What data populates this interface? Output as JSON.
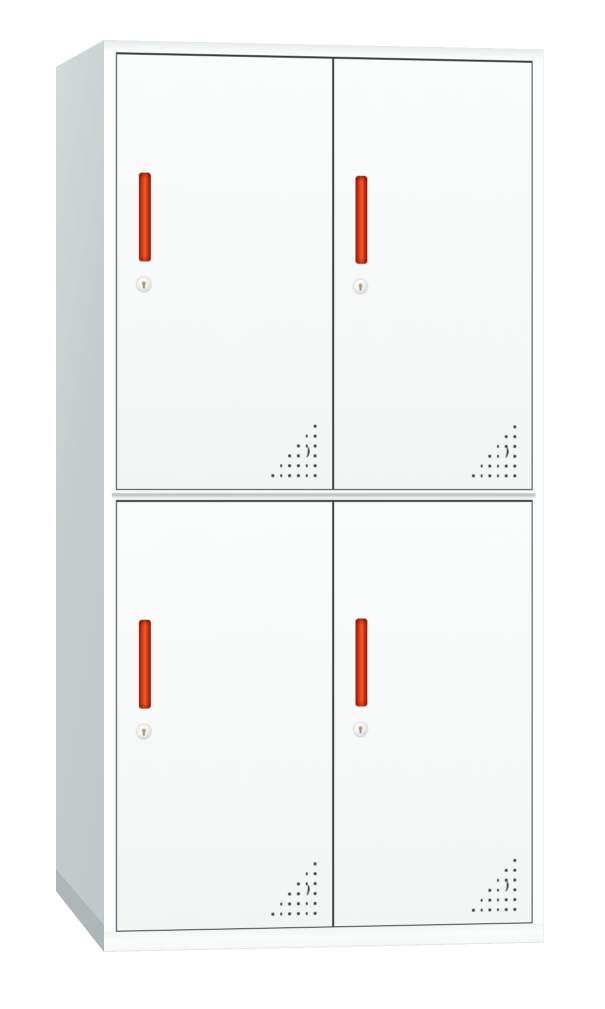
{
  "scene": {
    "type": "product-photo",
    "subject": "four-door metal locker cabinet",
    "background_color": "#ffffff"
  },
  "cabinet": {
    "rows": 2,
    "columns": 2,
    "door_count": 4,
    "body_color": "#fcfdfd",
    "side_panel_color": "#c7cdce",
    "door_color": "#f7f9f9",
    "door_border_color": "#3a3e41",
    "handle_color": "#e8491e",
    "handle_dark_color": "#8e1f0a",
    "lock_color": "#e9eae7",
    "vent_hole_color": "#3c3c3c",
    "doors": [
      {
        "id": "top-left",
        "handle": "red-vertical-bar",
        "lock": "round-cam-lock",
        "vents": "triangular-dot-grid"
      },
      {
        "id": "top-right",
        "handle": "red-vertical-bar",
        "lock": "round-cam-lock",
        "vents": "triangular-dot-grid"
      },
      {
        "id": "bottom-left",
        "handle": "red-vertical-bar",
        "lock": "round-cam-lock",
        "vents": "triangular-dot-grid"
      },
      {
        "id": "bottom-right",
        "handle": "red-vertical-bar",
        "lock": "round-cam-lock",
        "vents": "triangular-dot-grid"
      }
    ],
    "vent_pattern": {
      "rows": [
        [
          6
        ],
        [
          5,
          6
        ],
        [
          4,
          5,
          6
        ],
        [
          3,
          4,
          6
        ],
        [
          2,
          3,
          4,
          5,
          6
        ],
        [
          1,
          2,
          3,
          4,
          5,
          6
        ]
      ],
      "crescent": {
        "row": 3.2,
        "col": 5
      },
      "col_spacing": 8.6,
      "row_spacing": 10
    }
  }
}
